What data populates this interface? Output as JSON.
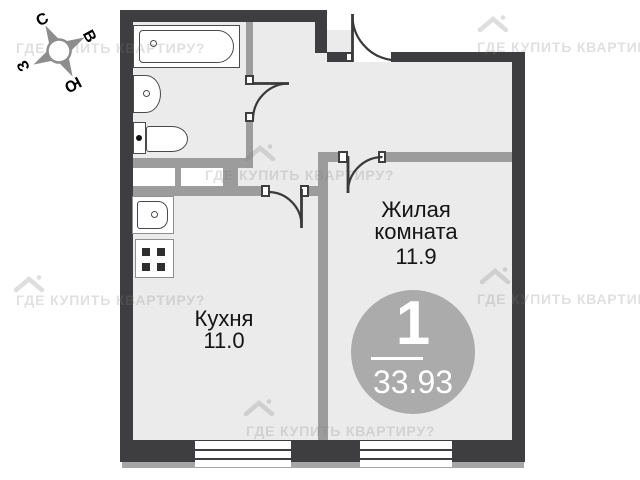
{
  "compass": {
    "n": "С",
    "e": "В",
    "w": "З",
    "s": "Ю"
  },
  "rooms": {
    "living_room": {
      "label_line1": "Жилая",
      "label_line2": "комната",
      "area": "11.9"
    },
    "kitchen": {
      "label": "Кухня",
      "area": "11.0"
    }
  },
  "summary_badge": {
    "room_count": "1",
    "total_area": "33.93"
  },
  "watermark": {
    "text": "ГДЕ КУПИТЬ КВАРТИРУ?"
  },
  "colors": {
    "wall_dark": "#3e3e40",
    "wall_light": "#9c9c9c",
    "floor": "#ebebeb",
    "badge": "#ababab"
  }
}
